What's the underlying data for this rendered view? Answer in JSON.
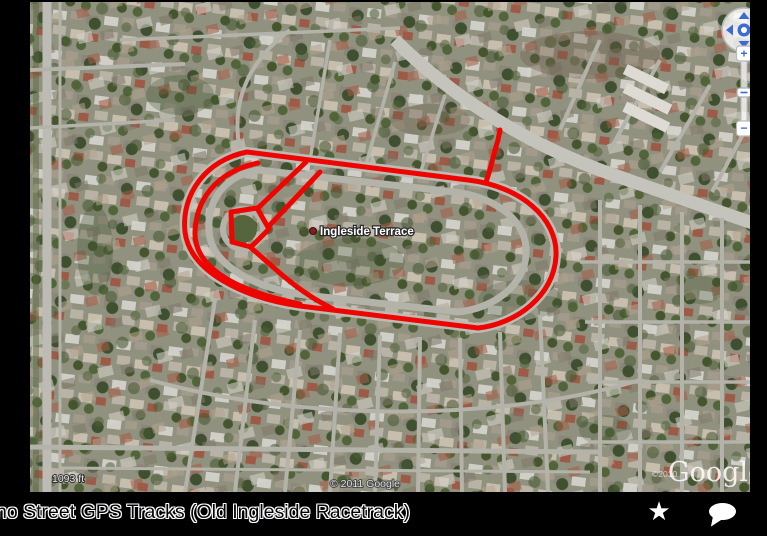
{
  "map": {
    "place_label": "Ingleside Terrace",
    "scale_text": "1093 ft",
    "copyright": "© 2011 Google",
    "watermark_small": "©2010",
    "watermark_logo": "Google",
    "controls": {
      "zoom_in": "+",
      "zoom_out": "−"
    },
    "track": {
      "color": "#ee0500",
      "width": 5,
      "paths": [
        "M 247 152 L 468 180 C 520 186 558 218 556 256 C 554 296 516 324 478 328 L 300 306 C 244 298 190 272 185 232 C 181 194 206 160 247 152 Z",
        "M 258 163 C 214 172 196 202 195 232 C 194 263 226 289 300 304",
        "M 231 212 L 257 208 L 269 229 L 251 247 L 232 242 Z",
        "M 306 162 L 257 209",
        "M 320 172 L 268 227",
        "M 250 247 C 275 268 295 290 333 309",
        "M 486 182 C 491 168 494 152 498 140 L 500 130"
      ]
    }
  },
  "footer": {
    "caption": "no Street GPS Tracks (Old Ingleside Racetrack)",
    "star_icon": "★"
  }
}
